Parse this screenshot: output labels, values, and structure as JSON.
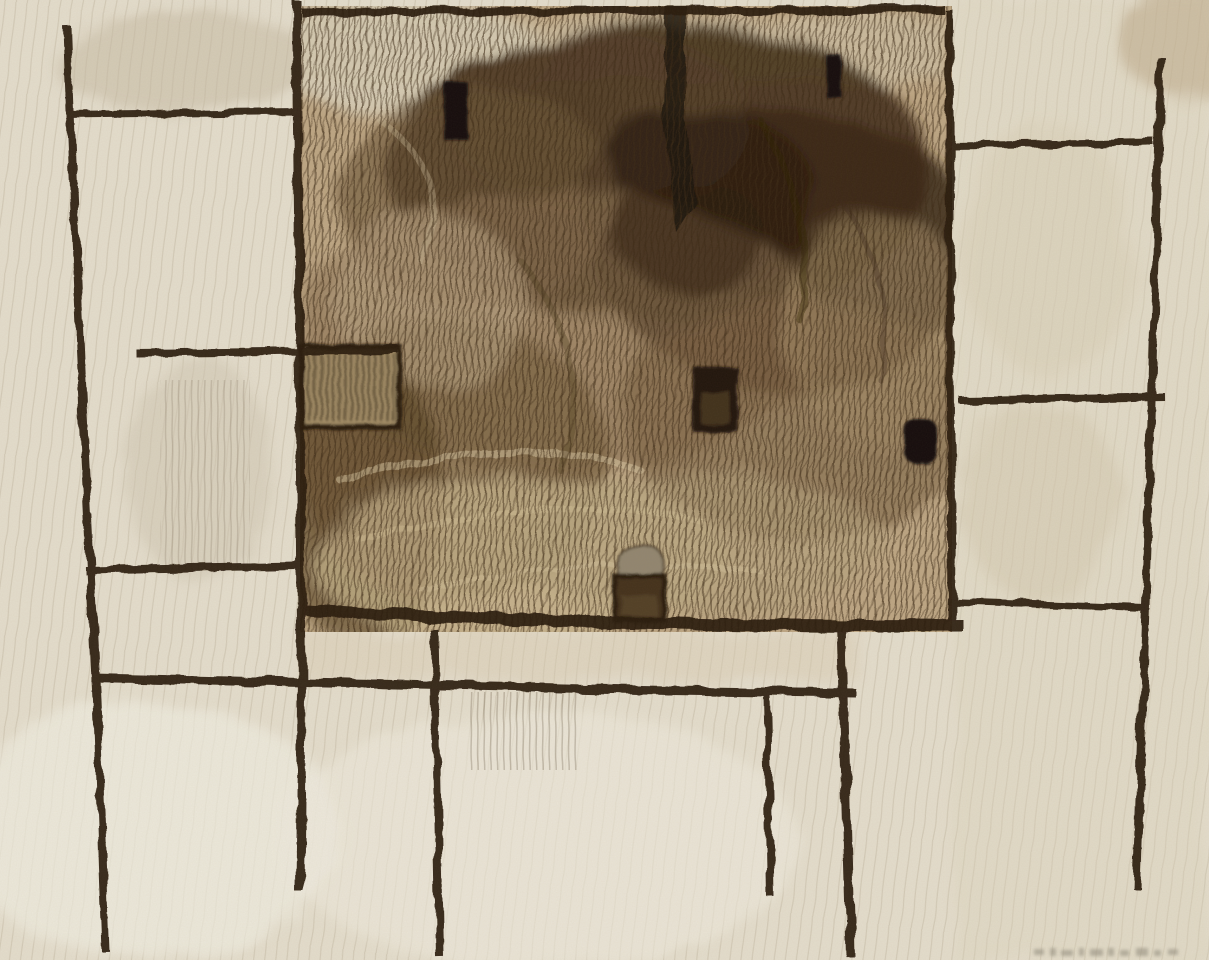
{
  "artwork": {
    "description": "Abstract charcoal and crayon drawing: a large scribbled sepia square crossed by a rough black grid of vertical and horizontal lines on cream paper, with small solid black rectangles, a hatched panel and a small pot-like shape",
    "medium_look": "charcoal / conte crayon on cream paper",
    "orientation": "landscape",
    "signature_marks": "faint illegible pencil marks at lower right"
  },
  "colors": {
    "paper": "#e4ddcc",
    "paper_light": "#efebdd",
    "paper_streak": "#b9ae97",
    "ink": "#2a1a0c",
    "field_base": "#bda684",
    "field_light": "#d6ccb4",
    "mass_dark": "#46321d",
    "mass_deep": "#2a1c0e",
    "mass_mid": "#876f51",
    "hatch": "#3e2c18",
    "block": "#15100a",
    "pot_cap": "#92866f",
    "pot_body": "#44331d",
    "box_fill": "#a38d66",
    "box_hatch": "#2e2012",
    "signature": "#908a7c"
  },
  "elements": [
    {
      "name": "central-scribble-field",
      "type": "textured square",
      "approx": "x300 y8 w650 h622"
    },
    {
      "name": "grid-line-vertical-far-left",
      "type": "line"
    },
    {
      "name": "grid-line-vertical-left",
      "type": "line"
    },
    {
      "name": "grid-line-vertical-square-right",
      "type": "line"
    },
    {
      "name": "grid-line-vertical-far-right",
      "type": "line"
    },
    {
      "name": "grid-line-vertical-bottom-center",
      "type": "line"
    },
    {
      "name": "grid-line-vertical-bottom-mid-right",
      "type": "line"
    },
    {
      "name": "grid-line-vertical-bottom-right",
      "type": "line"
    },
    {
      "name": "grid-line-horizontal-square-top",
      "type": "line"
    },
    {
      "name": "grid-line-horizontal-top-left",
      "type": "line"
    },
    {
      "name": "grid-line-horizontal-mid-left",
      "type": "line"
    },
    {
      "name": "grid-line-horizontal-right-upper",
      "type": "line"
    },
    {
      "name": "grid-line-horizontal-right-middle",
      "type": "line"
    },
    {
      "name": "grid-line-horizontal-left-lower",
      "type": "line"
    },
    {
      "name": "grid-line-horizontal-square-bottom",
      "type": "line"
    },
    {
      "name": "grid-line-horizontal-right-lower",
      "type": "line"
    },
    {
      "name": "grid-line-horizontal-below-square",
      "type": "line"
    },
    {
      "name": "black-block-upper-left",
      "type": "solid rectangle"
    },
    {
      "name": "black-block-upper-right",
      "type": "solid rectangle"
    },
    {
      "name": "black-block-center",
      "type": "solid rectangle"
    },
    {
      "name": "black-blob-right",
      "type": "solid rounded blob"
    },
    {
      "name": "hatched-panel",
      "type": "framed hatched rectangle"
    },
    {
      "name": "pot-shape",
      "type": "small vessel with cap"
    },
    {
      "name": "dark-trunk-stroke",
      "type": "vertical dark streak"
    },
    {
      "name": "signature-marks",
      "type": "faint pencil dashes"
    }
  ]
}
